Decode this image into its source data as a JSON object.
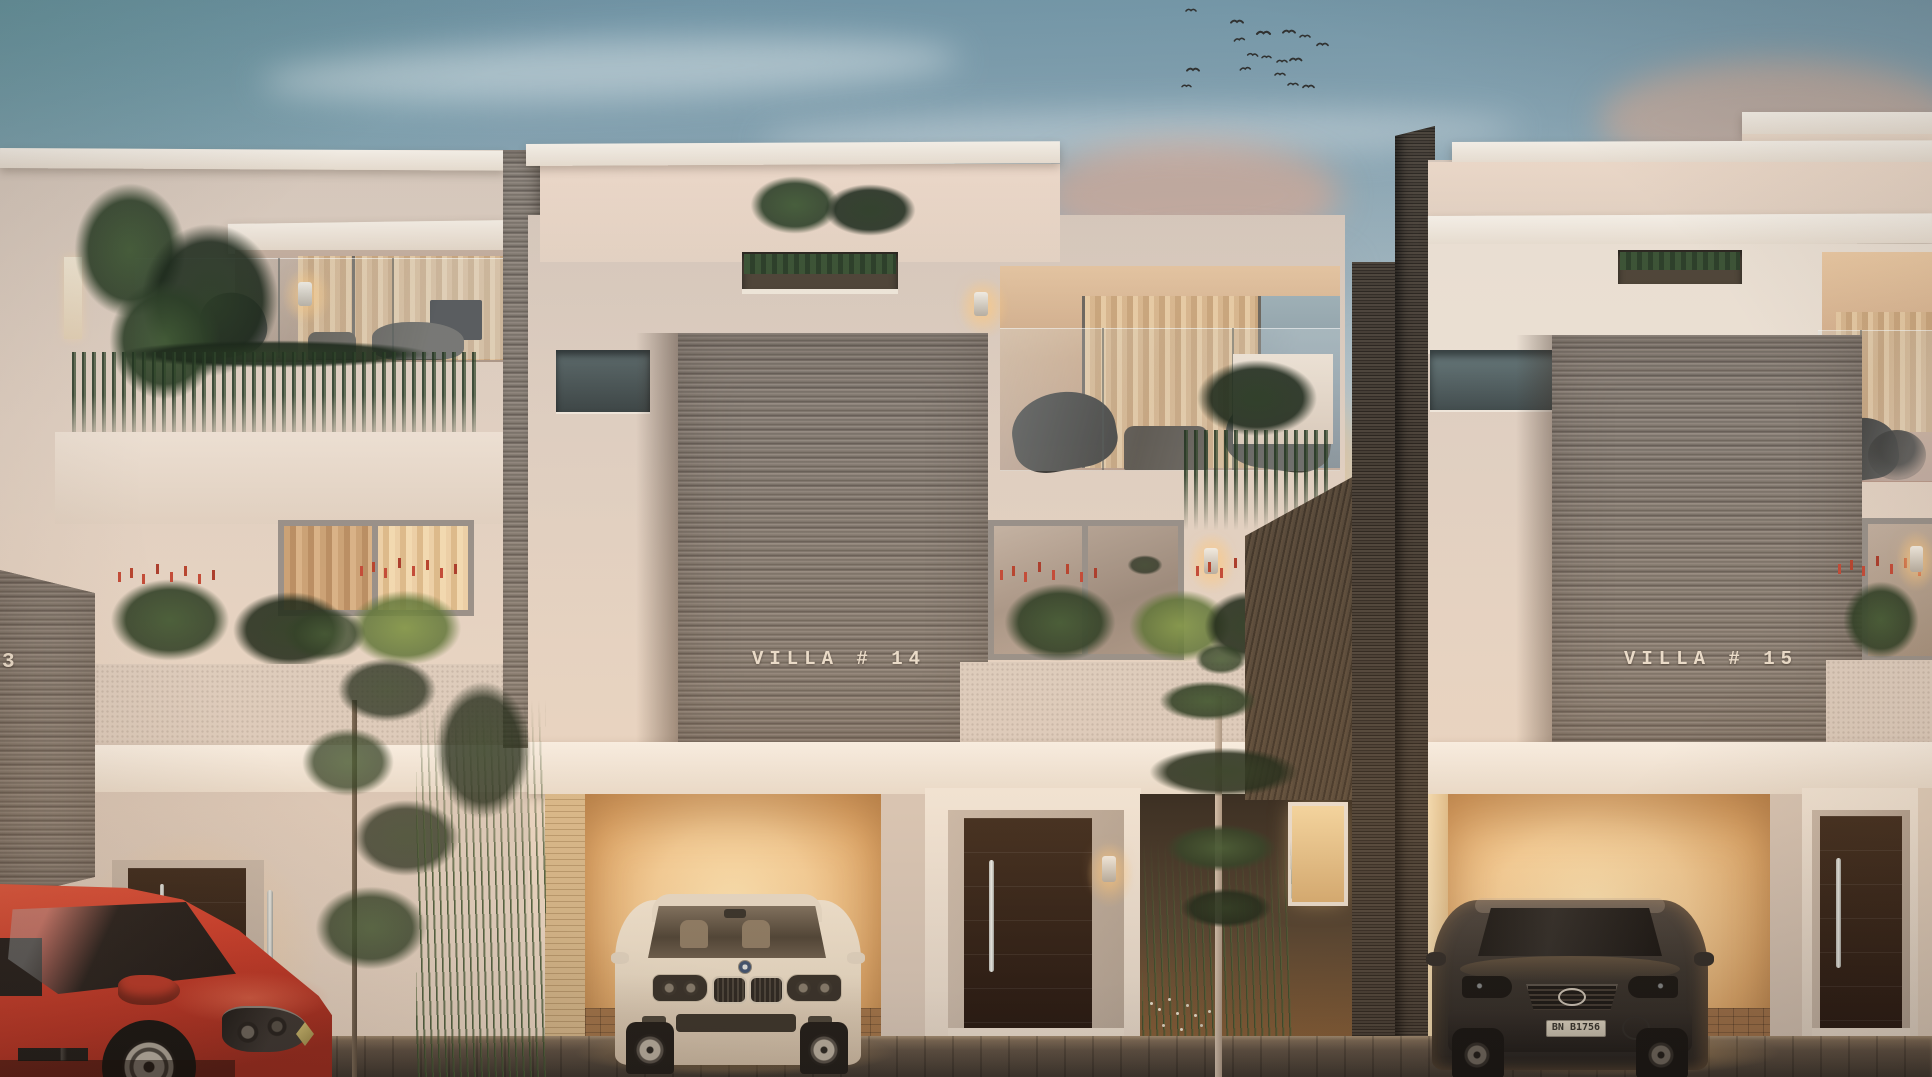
{
  "scene": {
    "description": "Dusk architectural rendering of a row of modern three-storey villas with warm-lit garages and entries",
    "villa_13": {
      "label_fragment": "3"
    },
    "villa_14": {
      "label": "VILLA # 14"
    },
    "villa_15": {
      "label": "VILLA # 15"
    },
    "cars": {
      "red_hatchback": {
        "body_color": "#d0402f"
      },
      "white_sedan": {
        "body_color": "#ece0cf"
      },
      "dark_suv": {
        "body_color": "#34302c",
        "license_plate": "BN B1756"
      }
    },
    "sky": {
      "top_color": "#6e92a3",
      "horizon_color": "#ead9c6",
      "sunset_cloud_color": "#e2a988",
      "birds_count": 17
    },
    "palette": {
      "stucco": "#e2d2c5",
      "white_trim": "#f2eae0",
      "stone": "#867d75",
      "dark_brick_wall": "#3c342d",
      "warm_garage_light": "#f6d29a",
      "door_wood": "#302117",
      "foliage": "#35492f",
      "red_flowers": "#c04a38",
      "pavement": "#46403a"
    }
  }
}
